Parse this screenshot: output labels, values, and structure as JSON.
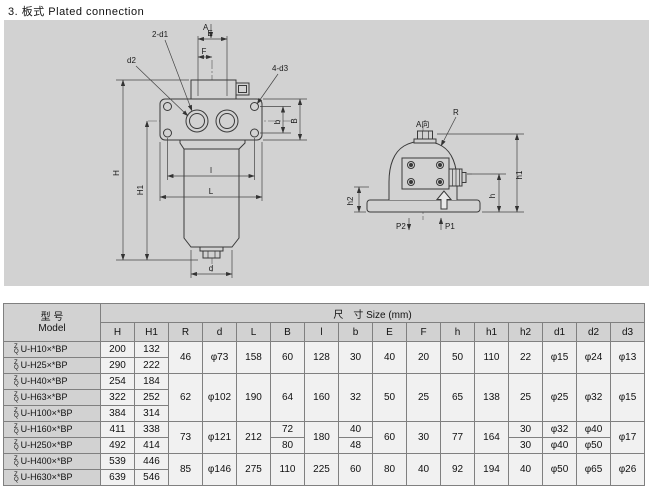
{
  "page": {
    "title": "3. 板式  Plated connection"
  },
  "colors": {
    "panel_bg": "#d2d2d2",
    "line": "#3a3a3a",
    "table_header_bg": "#d2d2d2"
  },
  "drawing": {
    "front": {
      "section_label": "A",
      "dim_E": "E",
      "dim_F": "F",
      "note_ports": "2-d1",
      "note_gauge": "d2",
      "note_holes": "4-d3",
      "dim_b": "b",
      "dim_B": "B",
      "dim_H": "H",
      "dim_H1": "H1",
      "dim_l": "l",
      "dim_L": "L",
      "dim_d": "d"
    },
    "side": {
      "view_label": "A向",
      "dim_R": "R",
      "dim_h1": "h1",
      "dim_h": "h",
      "dim_h2": "h2",
      "port_in": "P1",
      "port_out": "P2"
    }
  },
  "table": {
    "model_header_cn": "型  号",
    "model_header_en": "Model",
    "size_header": "尺　寸 Size (mm)",
    "model_prefix": {
      "top": "Z",
      "bottom": "Q"
    },
    "columns": [
      "H",
      "H1",
      "R",
      "d",
      "L",
      "B",
      "l",
      "b",
      "E",
      "F",
      "h",
      "h1",
      "h2",
      "d1",
      "d2",
      "d3"
    ],
    "rows": [
      {
        "model": "U-H10×*BP",
        "H": "200",
        "H1": "132",
        "R": "46",
        "d": "φ73",
        "L": "158",
        "B": "60",
        "l": "128",
        "b": "30",
        "E": "40",
        "F": "20",
        "h": "50",
        "h1": "110",
        "h2": "22",
        "d1": "φ15",
        "d2": "φ24",
        "d3": "φ13"
      },
      {
        "model": "U-H25×*BP",
        "H": "290",
        "H1": "222"
      },
      {
        "model": "U-H40×*BP",
        "H": "254",
        "H1": "184",
        "R": "62",
        "d": "φ102",
        "L": "190",
        "B": "64",
        "l": "160",
        "b": "32",
        "E": "50",
        "F": "25",
        "h": "65",
        "h1": "138",
        "h2": "25",
        "d1": "φ25",
        "d2": "φ32",
        "d3": "φ15"
      },
      {
        "model": "U-H63×*BP",
        "H": "322",
        "H1": "252"
      },
      {
        "model": "U-H100×*BP",
        "H": "384",
        "H1": "314"
      },
      {
        "model": "U-H160×*BP",
        "H": "411",
        "H1": "338",
        "R": "73",
        "d": "φ121",
        "L": "212",
        "B": "72",
        "l": "180",
        "b": "40",
        "E": "60",
        "F": "30",
        "h": "77",
        "h1": "164",
        "h2": "30",
        "d1": "φ32",
        "d2": "φ40",
        "d3": "φ17"
      },
      {
        "model": "U-H250×*BP",
        "H": "492",
        "H1": "414",
        "B": "80",
        "b": "48",
        "h2": "30",
        "d1": "φ40",
        "d2": "φ50"
      },
      {
        "model": "U-H400×*BP",
        "H": "539",
        "H1": "446",
        "R": "85",
        "d": "φ146",
        "L": "275",
        "B": "110",
        "l": "225",
        "b": "60",
        "E": "80",
        "F": "40",
        "h": "92",
        "h1": "194",
        "h2": "40",
        "d1": "φ50",
        "d2": "φ65",
        "d3": "φ26"
      },
      {
        "model": "U-H630×*BP",
        "H": "639",
        "H1": "546"
      }
    ]
  }
}
